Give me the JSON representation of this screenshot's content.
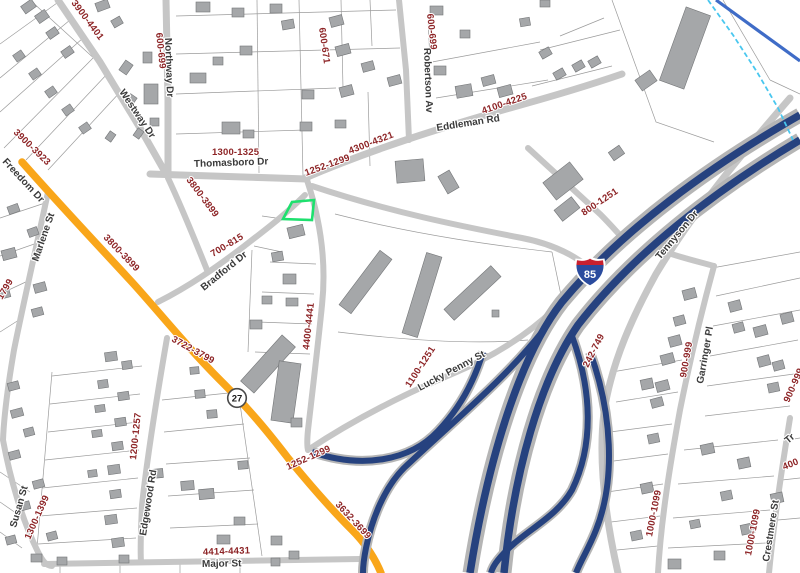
{
  "map": {
    "streets": {
      "freedom": "Freedom Dr",
      "westway": "Westway Dr",
      "northway": "Northway Dr",
      "thomasboro": "Thomasboro Dr",
      "robertson": "Robertson Av",
      "eddleman": "Eddleman Rd",
      "bradford": "Bradford Dr",
      "marlene": "Marlene St",
      "tennyson": "Tennyson Dr",
      "lucky_penny": "Lucky Penny St",
      "edgewood": "Edgewood Rd",
      "susan": "Susan St",
      "major": "Major St",
      "garringer": "Garringer Pl",
      "crestmere": "Crestmere St",
      "partial_tr": "Tr"
    },
    "address_ranges": {
      "r3900_4401": "3900-4401",
      "r600_699": "600-699",
      "r600_671": "600-671",
      "r4100_4225": "4100-4225",
      "r4300_4321": "4300-4321",
      "r1300_1325": "1300-1325",
      "r1252_1299": "1252-1299",
      "r3900_3923": "3900-3923",
      "r3800_3899": "3800-3899",
      "r700_815": "700-815",
      "r800_1251": "800-1251",
      "r4400_4441": "4400-4441",
      "r3722_3799": "3722-3799",
      "r1100_1251": "1100-1251",
      "r3632_3699": "3632-3699",
      "r1200_1257": "1200-1257",
      "r1300_1399": "1300-1399",
      "r4414_4431": "4414-4431",
      "r242_749": "242-749",
      "r900_999": "900-999",
      "r1000_1099": "1000-1099",
      "r1799_partial": "1799",
      "r400_partial": "400"
    },
    "shields": {
      "interstate_85": "85",
      "route_27": "27"
    },
    "colors": {
      "parcel_line": "#9b9b9b",
      "road": "#c6c6c6",
      "freedom_dr_orange": "#f9a61a",
      "freedom_dr_casing": "#e婦08e00",
      "freeway_blue": "#26427f",
      "freeway_casing": "#b5b5b5",
      "building_fill": "#a5a7a9",
      "building_stroke": "#737577",
      "selected_parcel_green": "#1ee06e",
      "street_label": "#3a3a3a",
      "address_label": "#8d2426",
      "stream_cyan": "#49c7ef",
      "canal_blue": "#3f6cc7",
      "shield_blue": "#2a4b9e",
      "shield_red": "#c8202f"
    }
  }
}
